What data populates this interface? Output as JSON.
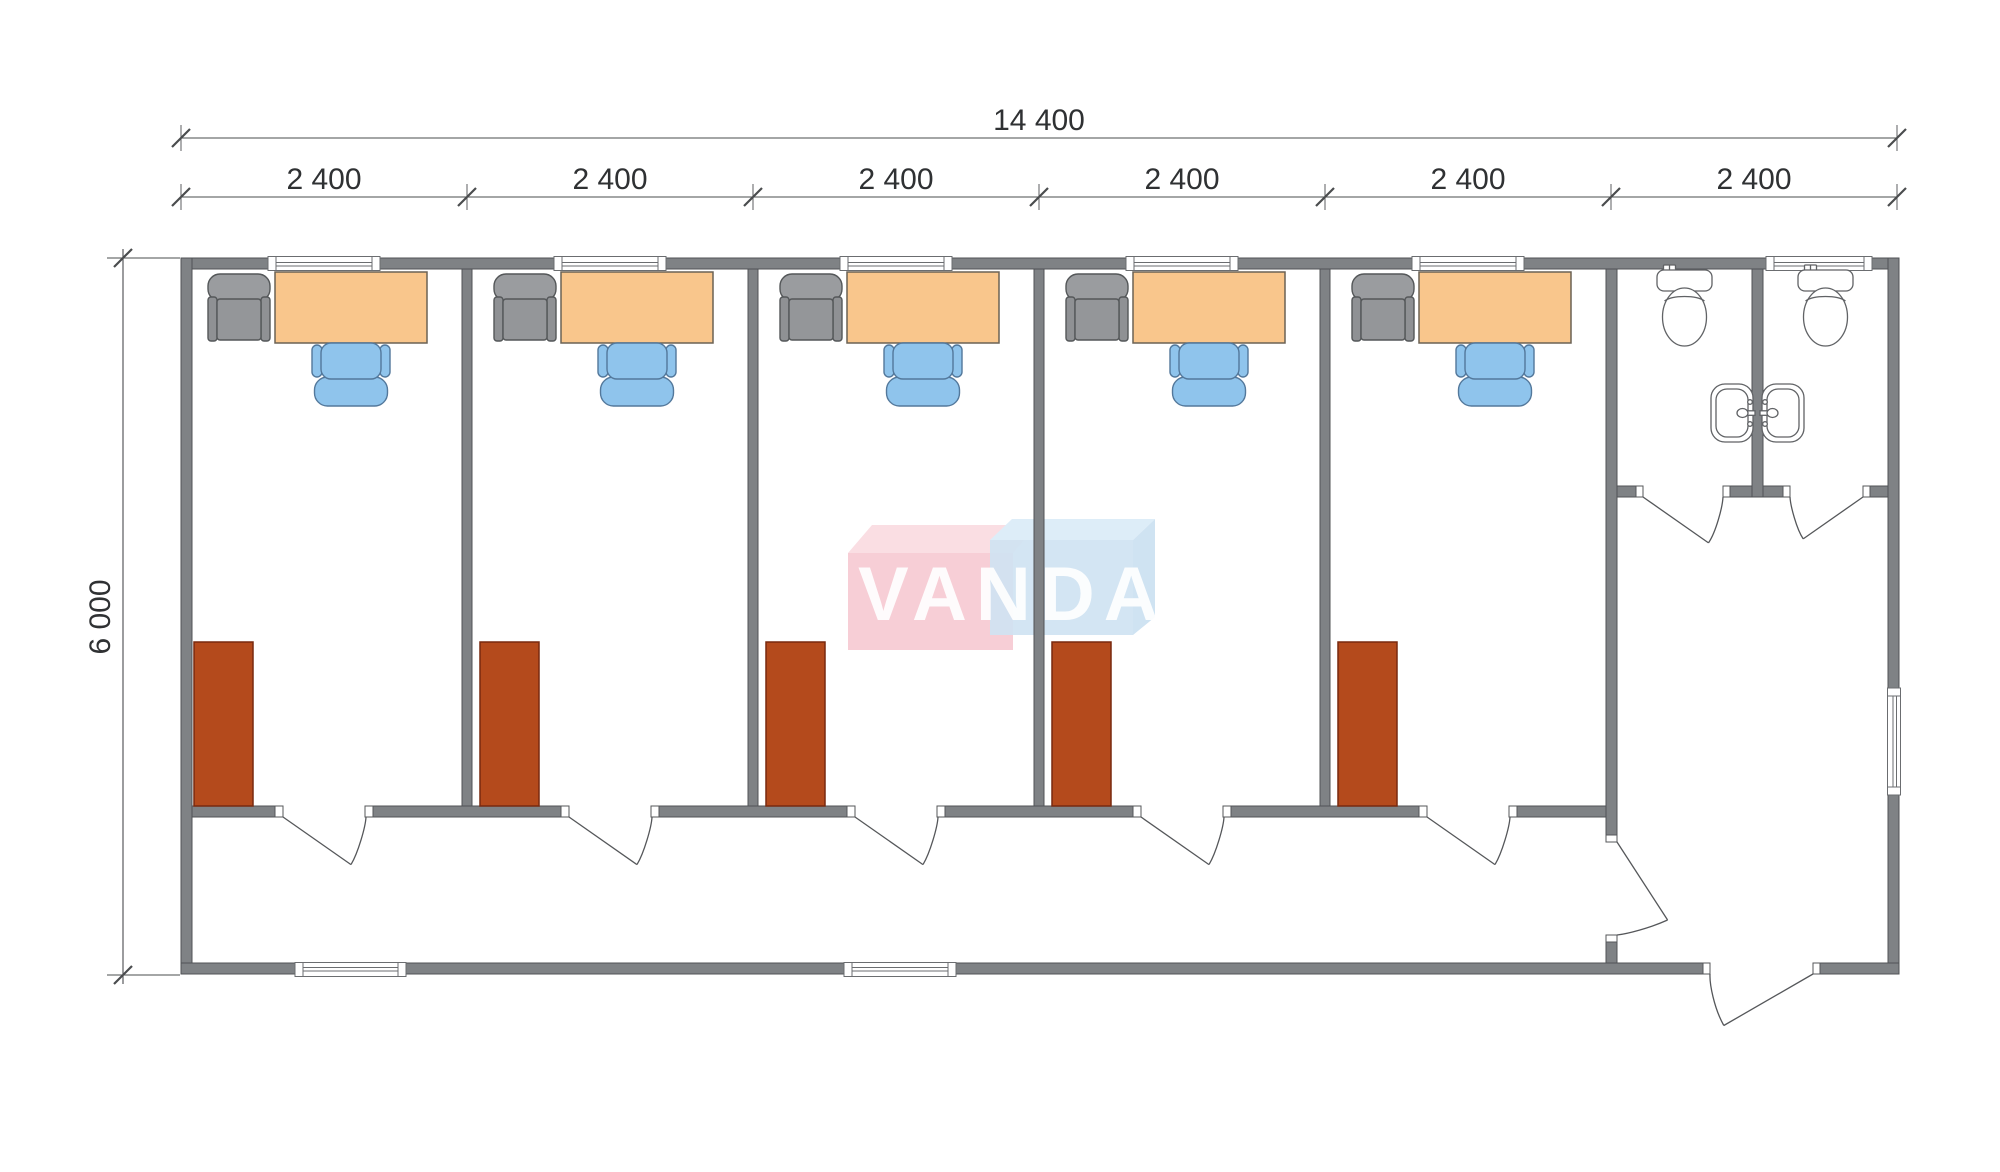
{
  "drawing": {
    "type": "floor-plan",
    "units": "mm",
    "building": {
      "width_mm": 14400,
      "depth_mm": 6000,
      "module_count": 6,
      "module_width_mm": 2400
    },
    "rooms": [
      {
        "type": "office",
        "furniture": [
          "armchair",
          "desk",
          "task-chair",
          "wardrobe"
        ],
        "window": true,
        "door": "corridor"
      },
      {
        "type": "office",
        "furniture": [
          "armchair",
          "desk",
          "task-chair",
          "wardrobe"
        ],
        "window": true,
        "door": "corridor"
      },
      {
        "type": "office",
        "furniture": [
          "armchair",
          "desk",
          "task-chair",
          "wardrobe"
        ],
        "window": true,
        "door": "corridor"
      },
      {
        "type": "office",
        "furniture": [
          "armchair",
          "desk",
          "task-chair",
          "wardrobe"
        ],
        "window": true,
        "door": "corridor"
      },
      {
        "type": "office",
        "furniture": [
          "armchair",
          "desk",
          "task-chair",
          "wardrobe"
        ],
        "window": true,
        "door": "corridor"
      },
      {
        "type": "sanitary",
        "fixtures": [
          "wc",
          "wc",
          "double-sink"
        ],
        "stalls": 2,
        "window": true,
        "doors": [
          "stall-1",
          "stall-2",
          "corridor-lobby",
          "entrance"
        ]
      }
    ]
  },
  "dimensions": {
    "total_width_label": "14 400",
    "bay_labels": [
      "2 400",
      "2 400",
      "2 400",
      "2 400",
      "2 400",
      "2 400"
    ],
    "height_label": "6 000"
  },
  "watermark": {
    "text": "VANDA",
    "pink_front": "#f7ced6",
    "pink_bevel": "#fadee3",
    "blue_front": "#cfe3f2",
    "blue_bevel": "#ddedf8"
  },
  "colors": {
    "wall_fill": "#7f8285",
    "wall_stroke": "#505356",
    "desk_fill": "#f9c68c",
    "chair_fill": "#8fc4ec",
    "chair_stroke": "#53789b",
    "armchair_fill": "#949699",
    "wardrobe_fill": "#b44a1c",
    "wardrobe_stroke": "#78290e",
    "fixture_stroke": "#606265",
    "dimension_color": "#2f3133"
  }
}
